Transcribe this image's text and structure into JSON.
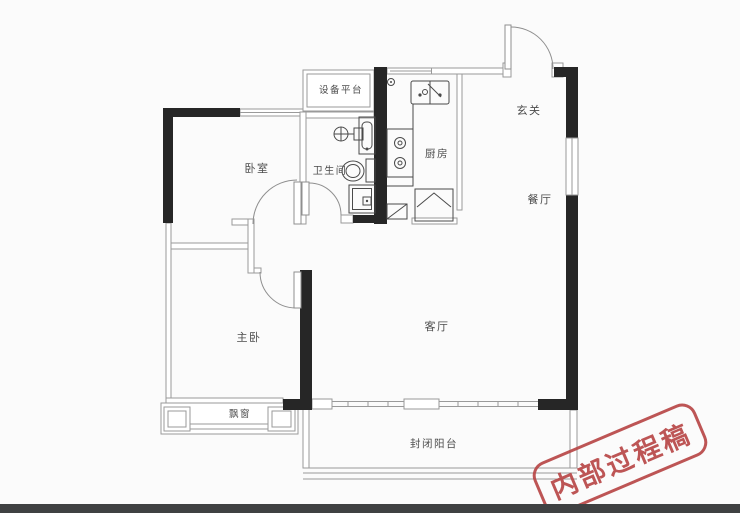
{
  "image_type": "apartment-floor-plan",
  "watermark": {
    "text": "内部过程稿"
  },
  "rooms": {
    "equipment_platform": {
      "label": "设备平台"
    },
    "bedroom": {
      "label": "卧室"
    },
    "bathroom": {
      "label": "卫生间"
    },
    "kitchen": {
      "label": "厨房"
    },
    "entrance": {
      "label": "玄关"
    },
    "dining": {
      "label": "餐厅"
    },
    "living": {
      "label": "客厅"
    },
    "master_bedroom": {
      "label": "主卧"
    },
    "bay_window": {
      "label": "飘窗"
    },
    "balcony": {
      "label": "封闭阳台"
    }
  },
  "fixtures": [
    "entry-door",
    "bedroom-door",
    "master-bedroom-door",
    "bathroom-door",
    "toilet",
    "bathroom-sink",
    "washing-machine",
    "shower",
    "kitchen-sink",
    "gas-stove",
    "refrigerator",
    "gas-meter"
  ],
  "colors": {
    "wall": "#262626",
    "thin_line": "#9a9a9a",
    "fixture_line": "#4a4a4a",
    "label_text": "#4c4c4c",
    "stamp_red": "#b84747",
    "background": "#fbfbfb",
    "bottom_bar": "#3f4142"
  }
}
